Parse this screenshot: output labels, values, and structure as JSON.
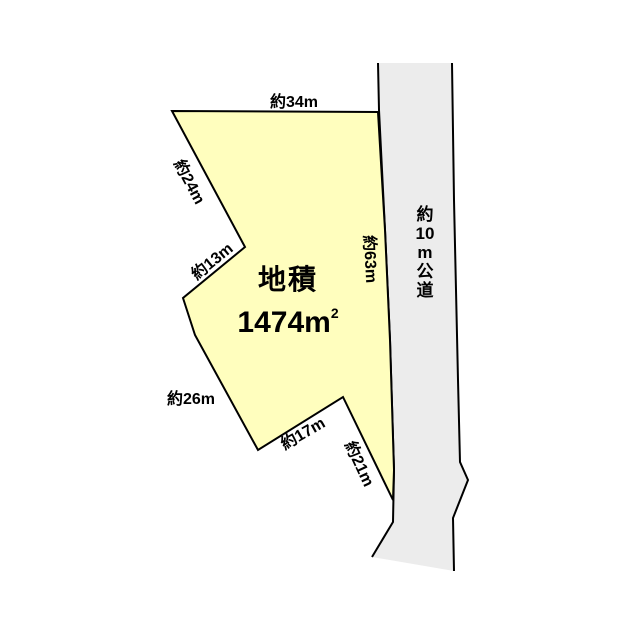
{
  "parcel": {
    "area_label": "地積",
    "area_value": "1474m",
    "area_superscript": "2",
    "fill_color": "#FFFEBE"
  },
  "dimensions": {
    "top": "約34m",
    "upper_left": "約24m",
    "left_notch": "約13m",
    "road_side": "約63m",
    "lower_left": "約26m",
    "bottom": "約17m",
    "bottom_right": "約21m"
  },
  "road": {
    "label_text": "約10m公道",
    "label_lines": [
      "約",
      "10",
      "m",
      "公",
      "道"
    ],
    "fill_color": "#ECECEC"
  },
  "line_color": "#000000"
}
